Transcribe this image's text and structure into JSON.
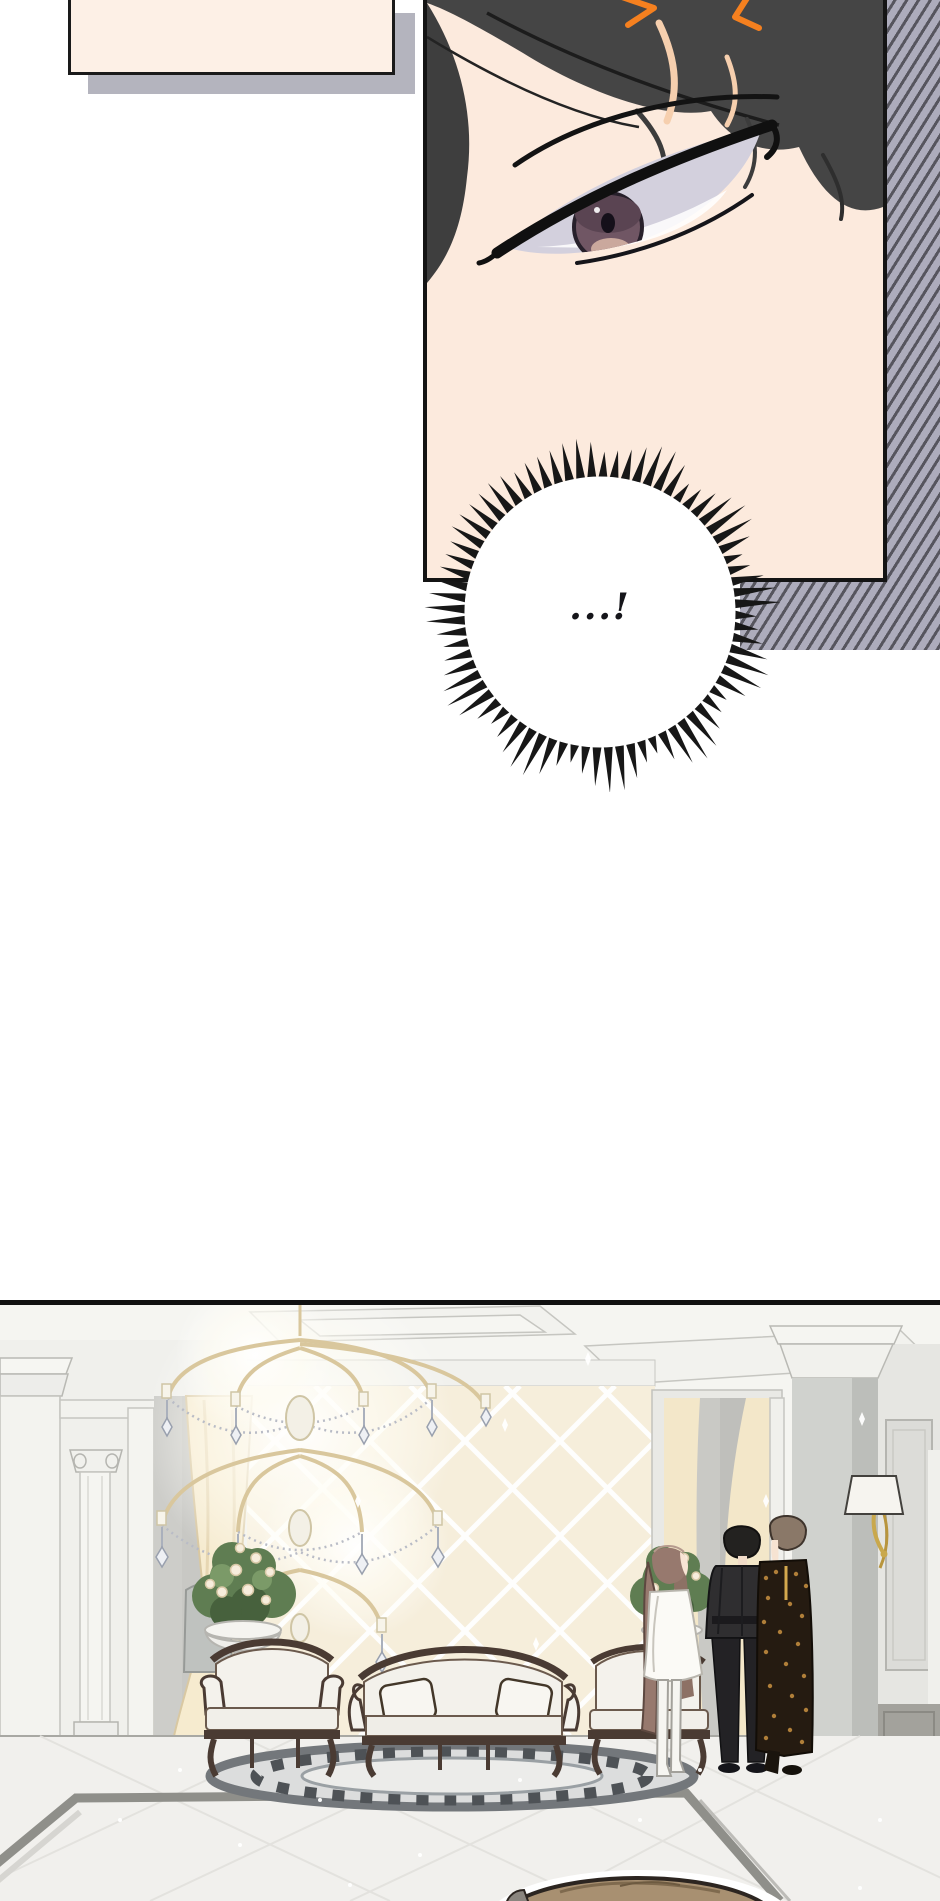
{
  "page": {
    "width": 940,
    "height": 1901,
    "bg": "#ffffff",
    "kind": "webtoon-comic-segment"
  },
  "panels": {
    "speech_box": {
      "fill": "#fdf0e6",
      "border_color": "#1a1a1a",
      "shadow_color": "#b4b4be"
    },
    "face_panel": {
      "description": "close-up of a dark-haired character's eye glancing sideways",
      "skin": "#fceadd",
      "hair": "#454545",
      "hair_line": "#1c1c1c",
      "anger_mark": "#f5801f",
      "skin_shadow": "#f6cfae",
      "eye_sclera": "#d3d0dd",
      "eye_iris": "#705664",
      "eye_iris_dark": "#5a4452",
      "eye_pupil": "#15101a",
      "eye_lower": "#caa89d",
      "lash": "#101010"
    },
    "stripe_background": {
      "light": "#adacbc",
      "dark": "#56555e"
    },
    "burst_bubble": {
      "text": "...!",
      "fill": "#ffffff",
      "spike_color": "#171717"
    },
    "hall_scene": {
      "description": "luxurious hall: chandelier, diamond-tiled wall, curtains, columns, sofas, rose planters, three standing figures",
      "border_color": "#111111",
      "ceiling": "#f5f5f1",
      "wall_tile": "#f6eedb",
      "tile_grout": "#ffffff",
      "wall_white": "#f0f0ec",
      "pillar_gray": "#d0d2ce",
      "pillar_shade": "#bcbeba",
      "fore_pillar": "#b3b3b1",
      "recess_gray": "#cdcdc9",
      "curtain": "#f6ebcf",
      "curtain_fold": "#e6d6b2",
      "doorway_gray": "#c9c9c5",
      "wainscot": "#a3a29c",
      "floor": "#f1f0ed",
      "floor_strip": "#8f8f8a",
      "rug_light": "#dcdddd",
      "rug_dark": "#4e5256",
      "rug_edge": "#73777b",
      "sofa_fabric": "#f4f2ec",
      "sofa_wood": "#4a3b33",
      "plant_green": "#5f7d52",
      "plant_dark": "#47613d",
      "rose": "#f7eddc",
      "sconce_shade": "#f6f4ef",
      "gold": "#c9a84c",
      "chandelier_gold": "#d9c79d",
      "figures": [
        {
          "label": "woman-white-dress",
          "hair": "#97796e",
          "dress": "#fbfaf6",
          "boots": "#f6f5f1"
        },
        {
          "label": "man-black-suit",
          "hair": "#232220",
          "suit": "#2f2e30"
        },
        {
          "label": "man-leopard-coat",
          "hair": "#8a7868",
          "coat": "#251b11",
          "spots": "#c08a3e"
        }
      ]
    },
    "next_panel_head": {
      "hair": "#a89071",
      "outline": "#2c2520",
      "halo": "#ffffff"
    }
  }
}
